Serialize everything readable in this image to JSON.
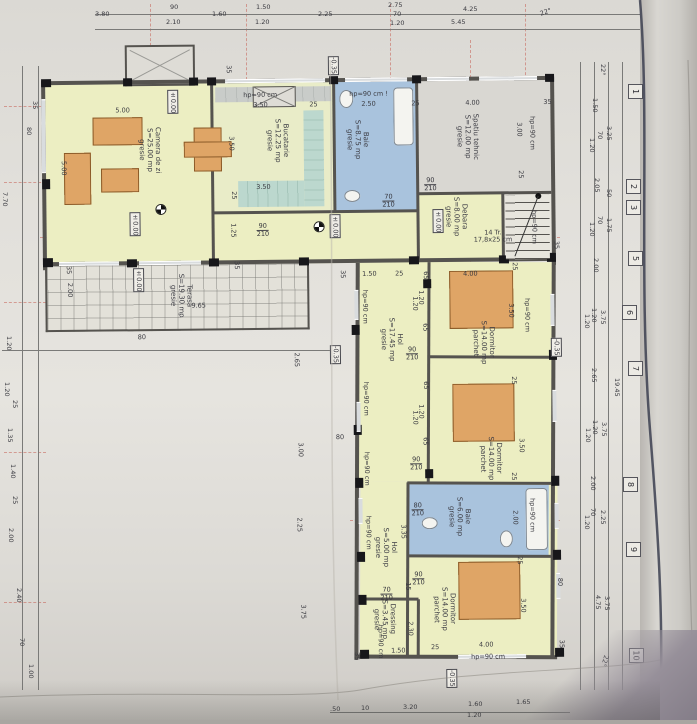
{
  "drawing": {
    "type": "ground-floor architectural plan",
    "angle_note": "22°"
  },
  "rooms": [
    {
      "name": "Camera de zi",
      "area": "S=25.00 mp",
      "floor": "gresie"
    },
    {
      "name": "Bucatarie",
      "area": "S=12.25 mp",
      "floor": "gresie"
    },
    {
      "name": "Baie",
      "area": "S=8.75 mp",
      "floor": "gresie"
    },
    {
      "name": "Spatiu tehnic",
      "area": "S=12.00 mp",
      "floor": "gresie"
    },
    {
      "name": "Debara",
      "area": "S=8.00 mp",
      "floor": "gresie"
    },
    {
      "name": "Terasa",
      "area": "S=19.30 mp",
      "floor": "gresie"
    },
    {
      "name": "Hol",
      "area": "S=17.45 mp",
      "floor": "gresie"
    },
    {
      "name": "Dormitor",
      "area": "S=14.00 mp",
      "floor": "parchet"
    },
    {
      "name": "Dormitor",
      "area": "S=14.00 mp",
      "floor": "parchet"
    },
    {
      "name": "Baie",
      "area": "S=6.00 mp",
      "floor": "gresie"
    },
    {
      "name": "Hol",
      "area": "S=5.00 mp",
      "floor": "gresie"
    },
    {
      "name": "Dressing",
      "area": "S=3.45 mp",
      "floor": "gresie"
    },
    {
      "name": "Dormitor",
      "area": "S=14.00 mp",
      "floor": "parchet"
    }
  ],
  "stairs": {
    "line1": "14 Tr.",
    "line2": "17,8x25 cm"
  },
  "window_sill": "hp=90 cm",
  "window_sill_excl": "hp=90 cm !",
  "levels": {
    "zero": "±0.00",
    "minus": "-0.35"
  },
  "doors": {
    "d1": {
      "w": "90",
      "h": "210"
    },
    "d2": {
      "w": "70",
      "h": "210"
    },
    "d3": {
      "w": "90",
      "h": "210"
    },
    "d4": {
      "w": "90",
      "h": "210"
    },
    "d5": {
      "w": "90",
      "h": "210"
    },
    "d6": {
      "w": "80",
      "h": "210"
    },
    "d7": {
      "w": "90",
      "h": "210"
    },
    "d8": {
      "w": "70",
      "h": "210"
    }
  },
  "grid": [
    "1",
    "2",
    "3",
    "5",
    "6",
    "7",
    "8",
    "9",
    "10"
  ],
  "dims": {
    "top": [
      "3.80",
      "90",
      "2.10",
      "1.60",
      "1.50",
      "1.20",
      "2.25",
      "2.75",
      "70",
      "1.20",
      "4.25",
      "5.45",
      "22°"
    ],
    "right": [
      "22°",
      "1.50",
      "3.25",
      "70",
      "1.20",
      "2.05",
      "50",
      "1.75",
      "70",
      "1.20",
      "2.00",
      "3.75",
      "1.20",
      "1.20",
      "2.65",
      "19.45",
      "3.75",
      "1.20",
      "1.20",
      "2.00",
      "2.25",
      "70",
      "1.20",
      "3.75",
      "4.75",
      "22°"
    ],
    "left": [
      "35",
      "80",
      "7.70",
      "1.20",
      "1.20",
      "25",
      "1.35",
      "1.40",
      "25",
      "2.00",
      "2.40",
      "70",
      "1.00"
    ],
    "bottom": [
      ".50",
      "10",
      "3.20",
      "1.60",
      "1.20",
      "1.65"
    ],
    "inner": [
      "5.00",
      "5.00",
      "3.50",
      "25",
      "1.25",
      "3.50",
      "25",
      "3.50",
      "2.50",
      "25",
      "4.00",
      "35",
      "3.00",
      "25",
      "9.65",
      "2.00",
      "35",
      "35",
      "80",
      "35",
      "1.50",
      "25",
      "65",
      "1.20",
      "1.20",
      "65",
      "4.00",
      "25",
      "3.50",
      "65",
      "1.20",
      "1.20",
      "65",
      "25",
      "3.50",
      "25",
      "2.00",
      "3.35",
      "25",
      "15",
      "2.30",
      "1.50",
      "25",
      "4.00",
      "3.50",
      "35",
      "80",
      "2.65",
      "3.00",
      "2.25",
      "3.75",
      "35",
      "80",
      "35",
      "35"
    ]
  }
}
